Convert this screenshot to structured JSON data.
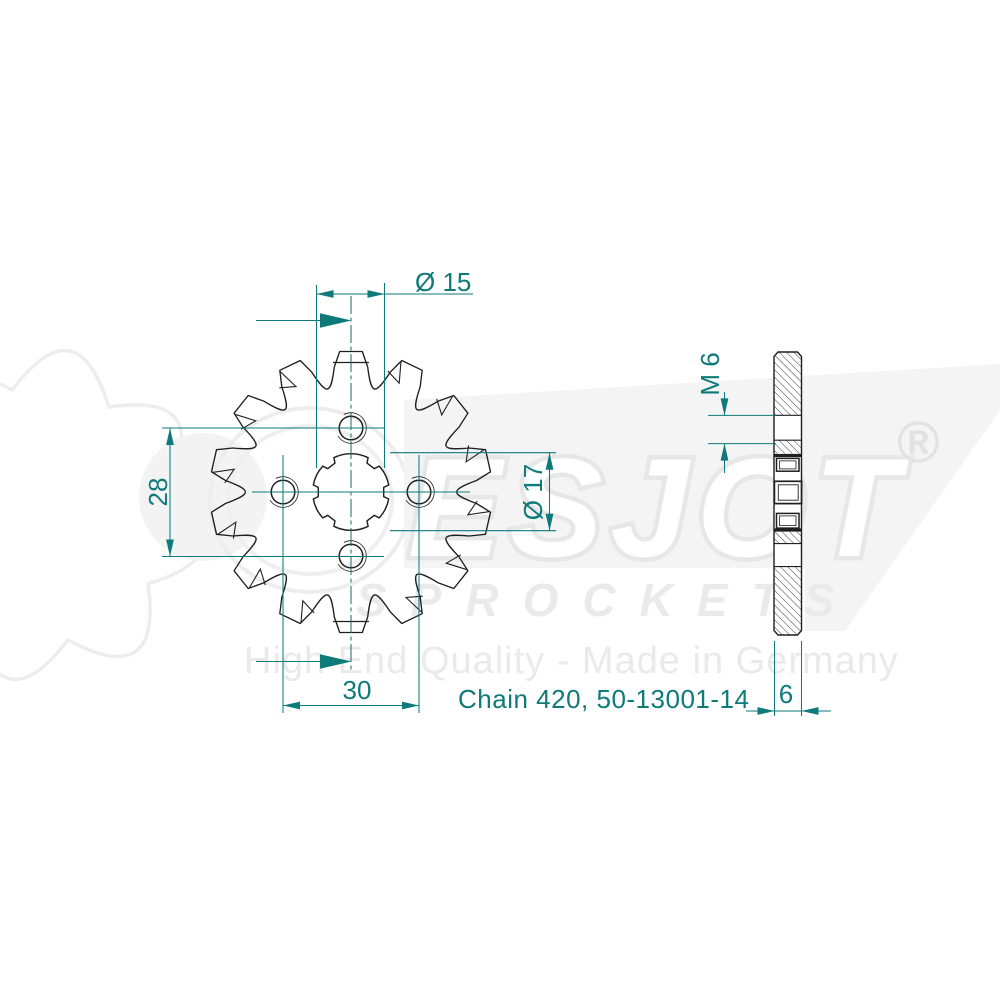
{
  "drawing": {
    "part_label": "Chain 420, 50-13001-14",
    "teeth_count": 14,
    "dimensions": {
      "spline_minor_dia": "Ø 15",
      "bolt_spacing_vertical": "28",
      "bolt_spacing_horizontal": "30",
      "bore_dia": "Ø 17",
      "thread": "M 6",
      "width": "6"
    }
  },
  "watermark": {
    "brand": "ESJOT",
    "registered": "®",
    "product_line": "SPROCKETS",
    "tagline": "High End Quality - Made in Germany"
  },
  "colors": {
    "dimension_teal": "#0e7a7a",
    "line_black": "#1f1f1f",
    "watermark_gray": "#ededed"
  }
}
